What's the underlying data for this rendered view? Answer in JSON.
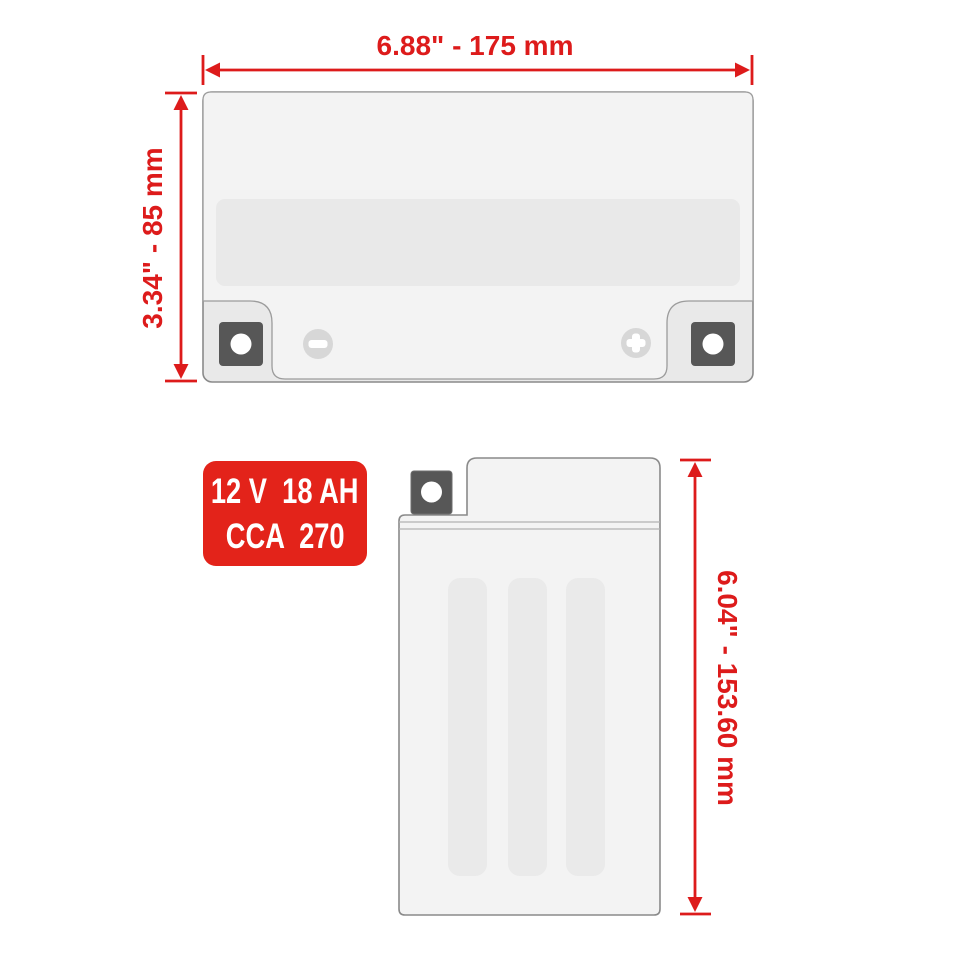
{
  "front_view": {
    "width_label": "6.88\" - 175 mm",
    "height_label": "3.34\" - 85 mm",
    "negative_terminal_symbol": "−",
    "positive_terminal_symbol": "+"
  },
  "side_view": {
    "height_label": "6.04\" - 153.60 mm"
  },
  "spec_badge": {
    "line1": "12 V  18 AH",
    "line2": "CCA  270"
  },
  "colors": {
    "dimension_red": "#dd1b1b",
    "badge_red": "#e3231a",
    "badge_text": "#ffffff",
    "battery_body": "#f3f3f3",
    "battery_panel": "#e9e9e9",
    "terminal_dark": "#575757",
    "terminal_bolt": "#ffffff",
    "polarity_circle": "#d7d7d7",
    "outline": "#8a8a8a"
  }
}
